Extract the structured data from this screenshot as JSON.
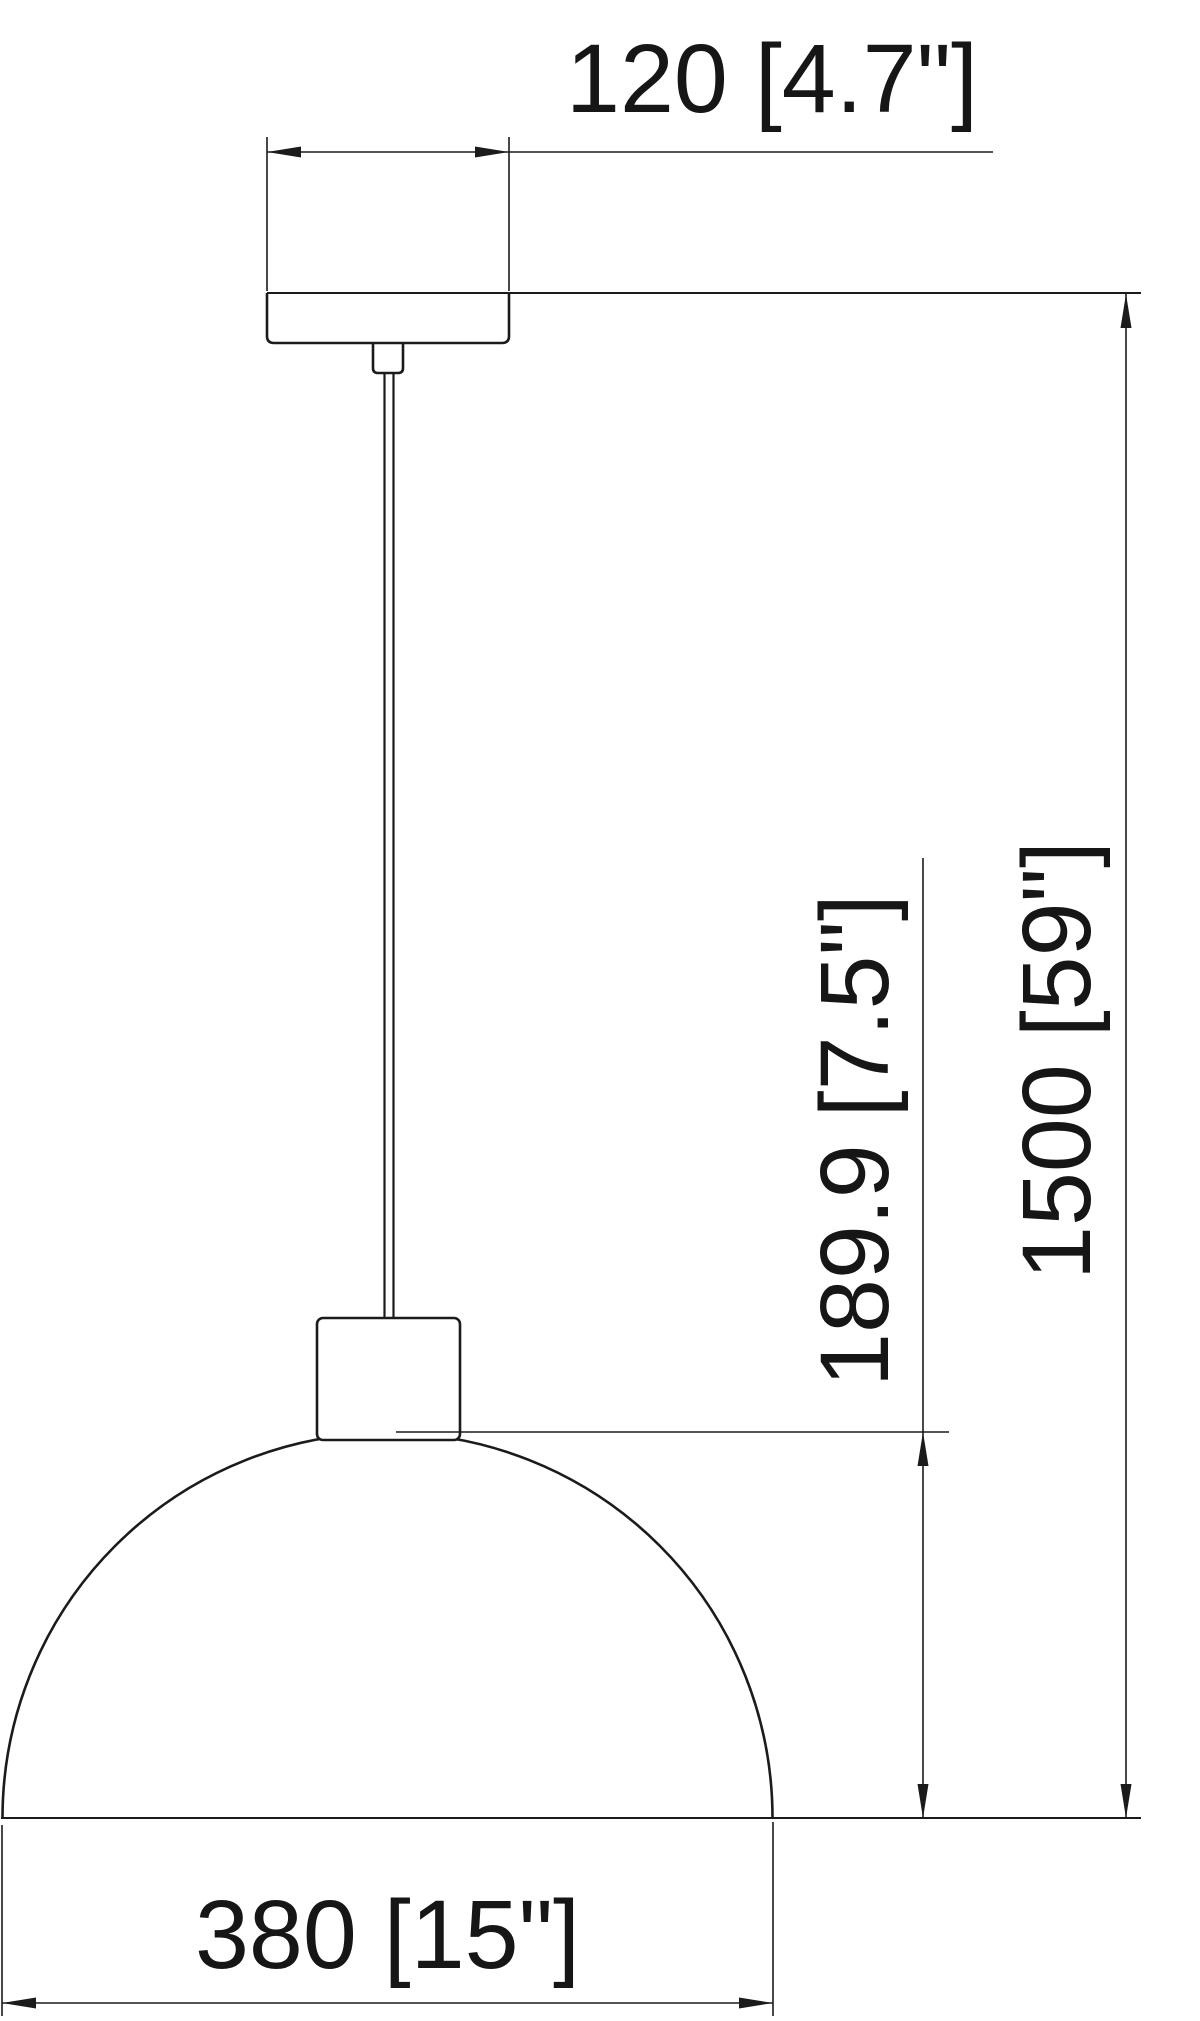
{
  "drawing": {
    "kind": "pendant-lamp-dimension-drawing",
    "background_color": "#ffffff",
    "line_color": "#1b1b1b",
    "dimensions": {
      "canopy_width": {
        "label": "120 [4.7\"]",
        "value_mm": "120",
        "value_in": "4.7\""
      },
      "shade_height": {
        "label": "189.9 [7.5\"]",
        "value_mm": "189.9",
        "value_in": "7.5\""
      },
      "overall_drop": {
        "label": "1500 [59\"]",
        "value_mm": "1500",
        "value_in": "59\""
      },
      "shade_diameter": {
        "label": "380 [15\"]",
        "value_mm": "380",
        "value_in": "15\""
      }
    }
  }
}
